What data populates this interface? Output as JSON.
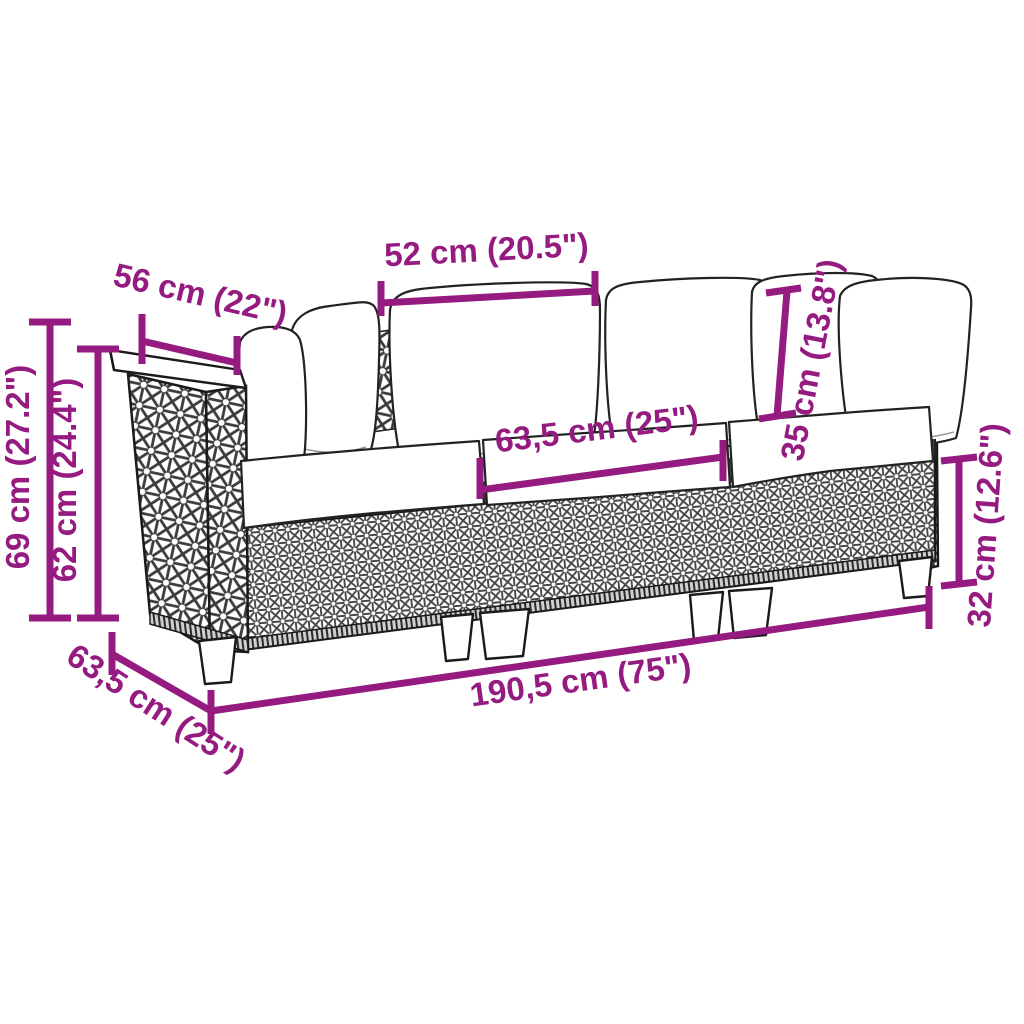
{
  "diagram": {
    "title": "Rattan 3-seater garden sofa — dimension diagram",
    "accent_color": "#951b81",
    "line_color": "#1a1a1a",
    "background": "#ffffff"
  },
  "dimensions": [
    {
      "id": "armrest-depth",
      "label": "56 cm (22\")"
    },
    {
      "id": "back-cushion-width",
      "label": "52 cm (20.5\")"
    },
    {
      "id": "back-cushion-height",
      "label": "35 cm (13.8\")"
    },
    {
      "id": "total-height",
      "label": "69 cm (27.2\")"
    },
    {
      "id": "armrest-height",
      "label": "62 cm (24.4\")"
    },
    {
      "id": "seat-cushion-width",
      "label": "63,5 cm (25\")"
    },
    {
      "id": "seat-height",
      "label": "32 cm (12.6\")"
    },
    {
      "id": "total-width",
      "label": "190,5 cm (75\")"
    },
    {
      "id": "seat-depth",
      "label": "63,5 cm (25\")"
    }
  ]
}
